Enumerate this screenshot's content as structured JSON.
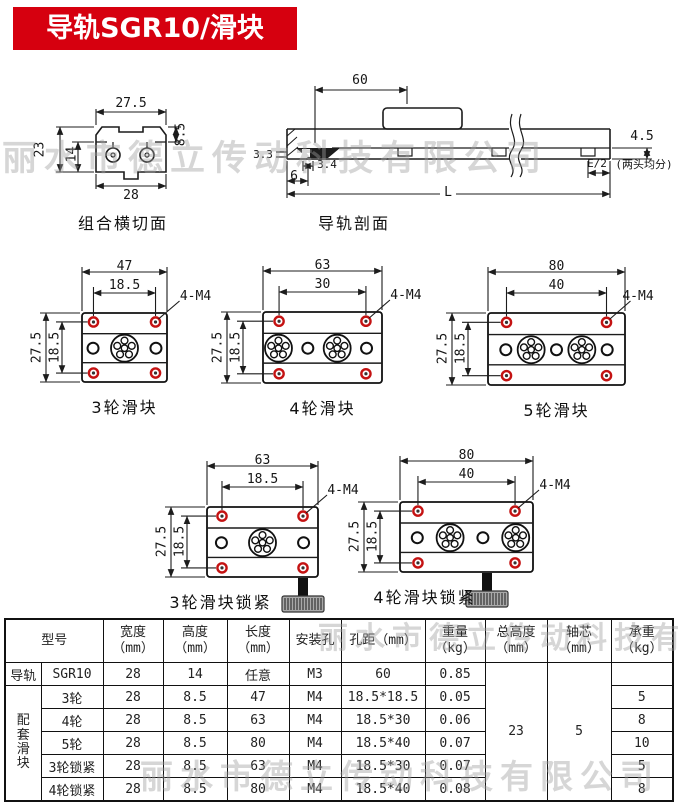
{
  "title": "导轨SGR10/滑块SGB10",
  "watermark": "丽水市德立传动科技有限公司",
  "colors": {
    "banner_red": "#d6000f",
    "hole_red": "#c41212",
    "line": "#1c1c1c"
  },
  "cross_section": {
    "caption": "组合横切面",
    "dims": {
      "width_top": "27.5",
      "height_right": "8.5",
      "height_outer": "23",
      "height_inner": "14",
      "width_bottom": "28"
    }
  },
  "rail_section": {
    "caption": "导轨剖面",
    "dims": {
      "hole_pitch": "60",
      "lip_height": "4.5",
      "hole_width": "3.4",
      "counterbore": "3.3",
      "edge_offset": "6",
      "length": "L",
      "end_span": "E/2",
      "end_note": "(两头均分)"
    }
  },
  "sliders": [
    {
      "caption": "3轮滑块",
      "dim_outer": "47",
      "dim_inner": "18.5",
      "thread": "4-M4",
      "dim_height": "27.5",
      "dim_inner_h": "18.5",
      "pattern": [
        "hole",
        "wheel",
        "hole"
      ],
      "lock": false
    },
    {
      "caption": "4轮滑块",
      "dim_outer": "63",
      "dim_inner": "30",
      "thread": "4-M4",
      "dim_height": "27.5",
      "dim_inner_h": "18.5",
      "pattern": [
        "wheel",
        "hole",
        "wheel",
        "hole"
      ],
      "lock": false
    },
    {
      "caption": "5轮滑块",
      "dim_outer": "80",
      "dim_inner": "40",
      "thread": "4-M4",
      "dim_height": "27.5",
      "dim_inner_h": "18.5",
      "pattern": [
        "hole",
        "wheel",
        "hole",
        "wheel",
        "hole"
      ],
      "lock": false
    },
    {
      "caption": "3轮滑块锁紧",
      "dim_outer": "63",
      "dim_inner": "18.5",
      "thread": "4-M4",
      "dim_height": "27.5",
      "dim_inner_h": "18.5",
      "pattern": [
        "hole",
        "wheel",
        "hole"
      ],
      "lock": true
    },
    {
      "caption": "4轮滑块锁紧",
      "dim_outer": "80",
      "dim_inner": "40",
      "thread": "4-M4",
      "dim_height": "27.5",
      "dim_inner_h": "18.5",
      "pattern": [
        "hole",
        "wheel",
        "hole",
        "wheel"
      ],
      "lock": true
    }
  ],
  "table": {
    "headers": [
      {
        "label": "型号",
        "unit": ""
      },
      {
        "label": "宽度",
        "unit": "（mm）"
      },
      {
        "label": "高度",
        "unit": "（mm）"
      },
      {
        "label": "长度",
        "unit": "（mm）"
      },
      {
        "label": "安装孔",
        "unit": ""
      },
      {
        "label": "孔距（mm）",
        "unit": ""
      },
      {
        "label": "重量",
        "unit": "（kg）"
      },
      {
        "label": "总高度",
        "unit": "（mm）"
      },
      {
        "label": "轴芯",
        "unit": "（mm）"
      },
      {
        "label": "承重",
        "unit": "（kg）"
      }
    ],
    "groups": [
      {
        "name": "导轨",
        "rows": [
          {
            "cells": [
              "SGR10",
              "28",
              "14",
              "任意",
              "M3",
              "60",
              "0.85"
            ],
            "load": ""
          }
        ]
      },
      {
        "name": "配套滑块",
        "rows": [
          {
            "cells": [
              "3轮",
              "28",
              "8.5",
              "47",
              "M4",
              "18.5*18.5",
              "0.05"
            ],
            "load": "5"
          },
          {
            "cells": [
              "4轮",
              "28",
              "8.5",
              "63",
              "M4",
              "18.5*30",
              "0.06"
            ],
            "load": "8"
          },
          {
            "cells": [
              "5轮",
              "28",
              "8.5",
              "80",
              "M4",
              "18.5*40",
              "0.07"
            ],
            "load": "10"
          },
          {
            "cells": [
              "3轮锁紧",
              "28",
              "8.5",
              "63",
              "M4",
              "18.5*30",
              "0.07"
            ],
            "load": "5"
          },
          {
            "cells": [
              "4轮锁紧",
              "28",
              "8.5",
              "80",
              "M4",
              "18.5*40",
              "0.08"
            ],
            "load": "8"
          }
        ]
      }
    ],
    "merged": {
      "total_height": "23",
      "shaft_core": "5"
    }
  }
}
